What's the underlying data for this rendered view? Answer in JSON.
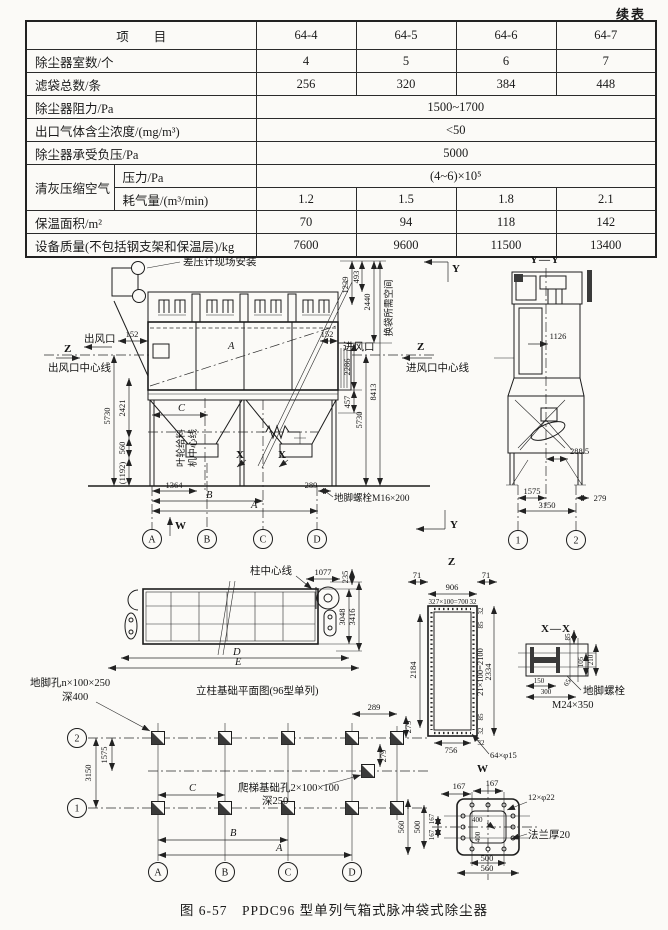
{
  "page": {
    "continued": "续表",
    "figure_caption": "图 6-57　PPDC96 型单列气箱式脉冲袋式除尘器"
  },
  "table": {
    "header": {
      "item": "项　　目",
      "models": [
        "64-4",
        "64-5",
        "64-6",
        "64-7"
      ]
    },
    "rows": {
      "chambers": {
        "label": "除尘器室数/个",
        "values": [
          "4",
          "5",
          "6",
          "7"
        ]
      },
      "bags": {
        "label": "滤袋总数/条",
        "values": [
          "256",
          "320",
          "384",
          "448"
        ]
      },
      "resistance": {
        "label": "除尘器阻力/Pa",
        "value": "1500~1700"
      },
      "outlet_conc": {
        "label": "出口气体含尘浓度/(mg/m³)",
        "value": "<50"
      },
      "neg_pressure": {
        "label": "除尘器承受负压/Pa",
        "value": "5000"
      },
      "clean_air_group": "清灰压缩空气",
      "pressure": {
        "label": "压力/Pa",
        "value": "(4~6)×10⁵"
      },
      "air_usage": {
        "label": "耗气量/(m³/min)",
        "values": [
          "1.2",
          "1.5",
          "1.8",
          "2.1"
        ]
      },
      "insulation": {
        "label": "保温面积/m²",
        "values": [
          "70",
          "94",
          "118",
          "142"
        ]
      },
      "mass": {
        "label": "设备质量(不包括钢支架和保温层)/kg",
        "values": [
          "7600",
          "9600",
          "11500",
          "13400"
        ]
      }
    }
  },
  "front": {
    "gauge_note": "差压计现场安装",
    "outlet": "出风口",
    "outlet_cl": "出风口中心线",
    "inlet": "进风口",
    "inlet_cl": "进风口中心线",
    "z_mark": "Z",
    "y_mark": "Y",
    "bag_space": "换袋所需空间",
    "feeder_cl_1": "叶轮给料",
    "feeder_cl_2": "机中心线",
    "anchor_bolt": "地脚螺栓M16×200",
    "x_mark": "X",
    "w_mark": "W",
    "dims": {
      "d152l": "152",
      "d152r": "152",
      "a": "A",
      "b": "B",
      "c": "C",
      "d1364": "1364",
      "d289": "289",
      "d5730l": "5730",
      "d2421": "2421",
      "d560": "560",
      "d1192": "(1192)",
      "d1239": "1239",
      "d493": "493",
      "d2440": "2440",
      "d2286": "2286",
      "d457": "457",
      "d5730r": "5730",
      "d8413": "8413"
    },
    "cols": [
      "A",
      "B",
      "C",
      "D"
    ]
  },
  "yy": {
    "title": "Y—Y",
    "d1126": "1126",
    "d288_5": "288.5",
    "d1575": "1575",
    "d279": "279",
    "d3150": "3150",
    "col1": "1",
    "col2": "2"
  },
  "plan": {
    "col_cl": "柱中心线",
    "d1077": "1077",
    "d235": "235",
    "d3048": "3048",
    "d3416": "3416",
    "dd": "D",
    "de": "E",
    "caption": "立柱基础平面图(96型单列)",
    "anchor_hole_1": "地脚孔n×100×250",
    "anchor_hole_2": "深400"
  },
  "zview": {
    "title": "Z",
    "d71l": "71",
    "d71r": "71",
    "d906": "906",
    "d32tl": "32",
    "spacing_h": "7×100=700",
    "d32tr": "32",
    "d2184": "2184",
    "d32r1": "32",
    "d85t": "85",
    "spacing_v": "21×100=2100",
    "d85b": "85",
    "d32r2": "32",
    "d2334": "2334",
    "d756": "756",
    "d32b": "32",
    "holes": "64×φ15"
  },
  "xx": {
    "title": "X—X",
    "d85": "85",
    "d105": "105",
    "d210": "210",
    "d150": "150",
    "d300": "300",
    "d65": "65",
    "bolt_1": "地脚螺栓",
    "bolt_2": "M24×350"
  },
  "foundation": {
    "row1": "1",
    "row2": "2",
    "d1575": "1575",
    "d3150": "3150",
    "da": "A",
    "db": "B",
    "dc": "C",
    "d289": "289",
    "d279a": "279",
    "d279b": "279",
    "ladder_hole_1": "爬梯基础孔2×100×100",
    "ladder_hole_2": "深250",
    "cols": [
      "A",
      "B",
      "C",
      "D"
    ]
  },
  "w": {
    "title": "W",
    "d167t1": "167",
    "d167t2": "167",
    "holes": "12×φ22",
    "d400a": "400",
    "d400b": "400",
    "flange": "法兰厚20",
    "d500b": "500",
    "d560b": "560",
    "d560l": "560",
    "d500l": "500",
    "d167l1": "167",
    "d167l2": "167"
  }
}
